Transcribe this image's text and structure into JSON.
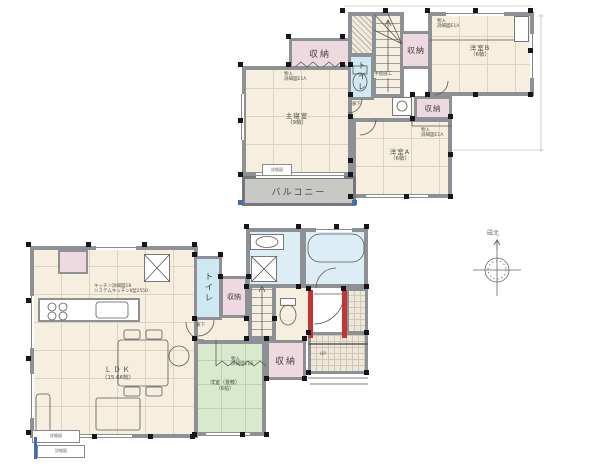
{
  "floor2": {
    "master_bedroom": {
      "name": "主寝室",
      "size": "（9帖）"
    },
    "western_room_a": {
      "name": "洋室A",
      "size": "（6帖）"
    },
    "western_room_b": {
      "name": "洋室B",
      "size": "（6帖）"
    },
    "closet_label": "収納",
    "toilet_label": "トイレ",
    "balcony_label": "バルコニー",
    "hallway_label": "廊下",
    "storage_note": {
      "line1": "物入",
      "line2": "詳細図E1A"
    },
    "handrail_note": "手摺施工",
    "window_callout": "詳細図"
  },
  "floor1": {
    "ldk": {
      "name": "ＬＤＫ",
      "size": "（15.66帖）"
    },
    "tatami_room": {
      "name": "洋室（畳敷）",
      "size": "（6帖）"
    },
    "closet_label": "収納",
    "toilet_label": "トイレ",
    "hallway_label": "廊下",
    "up_label": "UP",
    "kitchen_note": {
      "line1": "キッチン詳細図1B",
      "line2": "システムキッチンⅡ型2550"
    },
    "storage_note": {
      "line1": "物入",
      "line2": "詳細図E1B"
    },
    "window_callout1": "詳細図",
    "window_callout2": "詳細図"
  },
  "compass": {
    "label": "磁北"
  },
  "colors": {
    "floor_cream": "#f6efdf",
    "closet_pink": "#eed9e1",
    "toilet_cyan": "#cfe9f2",
    "bath_blue": "#dcedf5",
    "tatami_green": "#d9e9ce",
    "balcony_gray": "#c8c8c4",
    "wall_gray": "#8d9195",
    "new_wall_red": "#c43430",
    "column_black": "#15151a",
    "mark_blue": "#3a6fb7"
  }
}
